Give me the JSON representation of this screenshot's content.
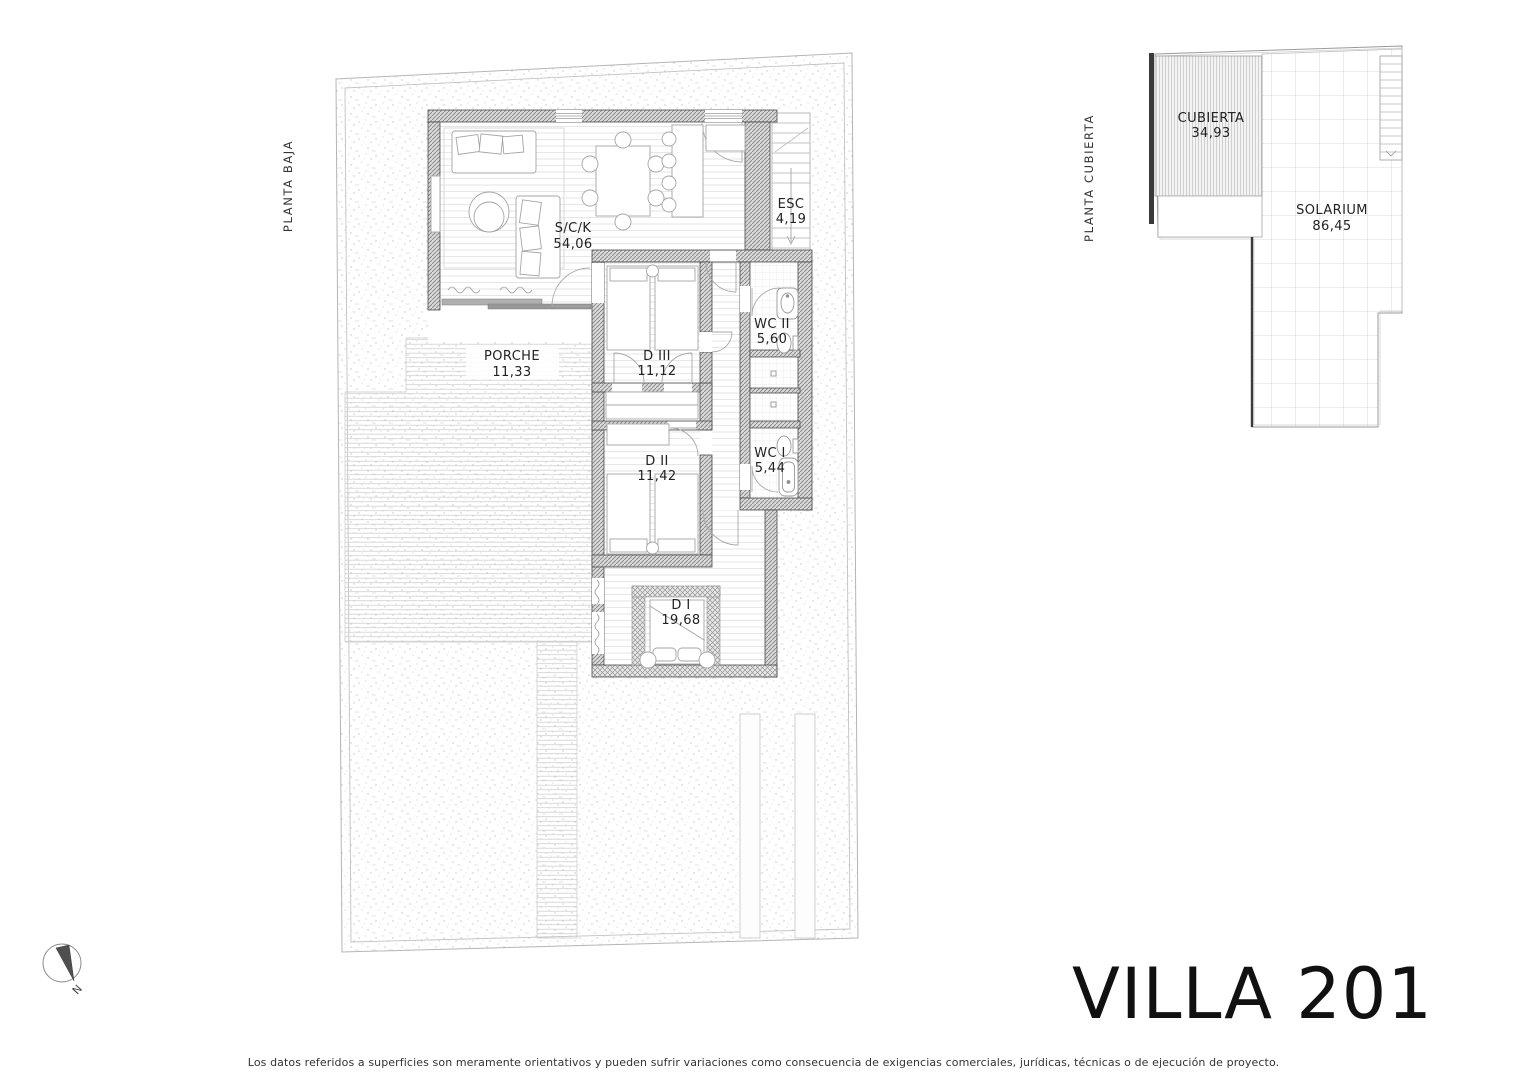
{
  "sheet": {
    "title": "VILLA 201",
    "disclaimer": "Los datos referidos a superficies son meramente orientativos y pueden sufrir variaciones como consecuencia de exigencias comerciales, jurídicas, técnicas o de ejecución de proyecto.",
    "north_label": "N"
  },
  "plans": {
    "ground": {
      "label": "PLANTA BAJA",
      "rooms": [
        {
          "name": "S/C/K",
          "area": "54,06"
        },
        {
          "name": "ESC",
          "area": "4,19"
        },
        {
          "name": "PORCHE",
          "area": "11,33"
        },
        {
          "name": "D III",
          "area": "11,12"
        },
        {
          "name": "WC II",
          "area": "5,60"
        },
        {
          "name": "D II",
          "area": "11,42"
        },
        {
          "name": "WC I",
          "area": "5,44"
        },
        {
          "name": "D I",
          "area": "19,68"
        }
      ]
    },
    "roof": {
      "label": "PLANTA CUBIERTA",
      "rooms": [
        {
          "name": "CUBIERTA",
          "area": "34,93"
        },
        {
          "name": "SOLARIUM",
          "area": "86,45"
        }
      ]
    }
  }
}
